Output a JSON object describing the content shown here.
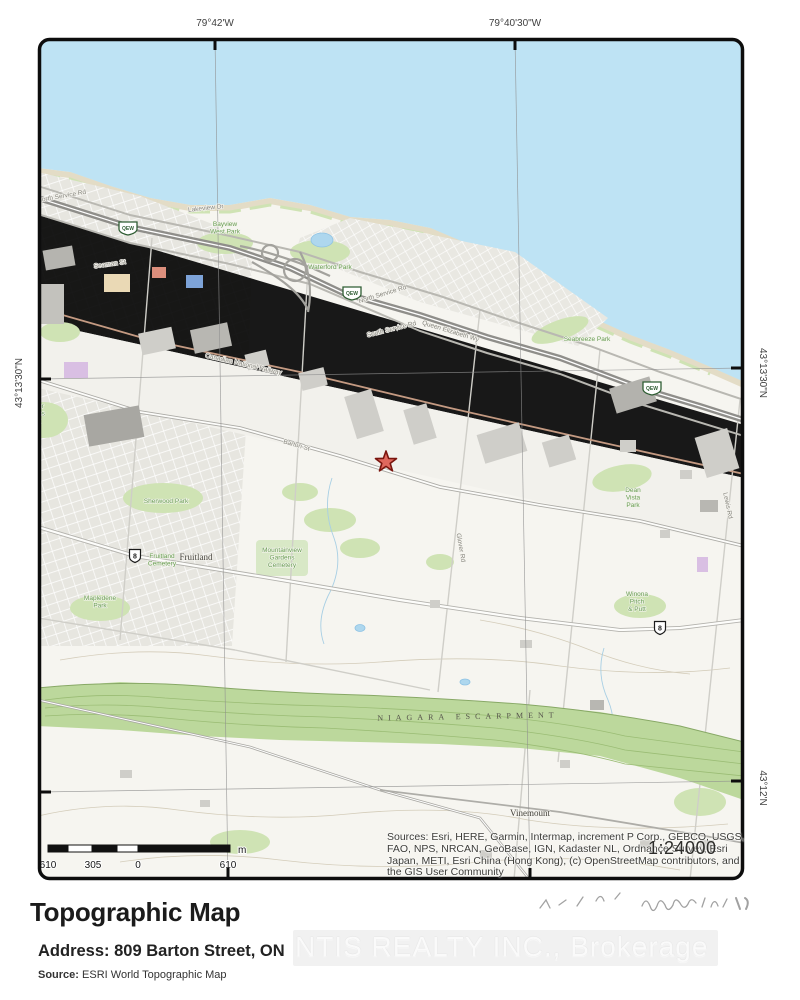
{
  "graticule": {
    "top": [
      {
        "label": "79°42'W"
      },
      {
        "label": "79°40'30\"W"
      }
    ],
    "left": [
      {
        "label": "43°13'30\"N"
      }
    ],
    "right": [
      {
        "label": "43°13'30\"N"
      },
      {
        "label": "43°12'N"
      }
    ]
  },
  "map": {
    "labels": [
      {
        "name": "road-label-north-service-rd-1",
        "t": "North Service Rd",
        "x": 62,
        "y": 198,
        "r": -10,
        "cls": "road"
      },
      {
        "name": "road-label-north-service-rd-2",
        "t": "North Service Rd",
        "x": 383,
        "y": 296,
        "r": -17,
        "cls": "road"
      },
      {
        "name": "road-label-south-service-rd",
        "t": "South Service Rd",
        "x": 392,
        "y": 331,
        "r": -14,
        "cls": "road"
      },
      {
        "name": "road-label-queen-elizabeth-wy",
        "t": "Queen Elizabeth Wy",
        "x": 450,
        "y": 333,
        "r": 17,
        "cls": "road",
        "size": 7
      },
      {
        "name": "rail-label-canadian-national-railway",
        "t": "Canadian National Railway",
        "x": 243,
        "y": 366,
        "r": 13,
        "cls": "road",
        "size": 6
      },
      {
        "name": "road-label-barton-st",
        "t": "Barton St",
        "x": 296,
        "y": 447,
        "r": 16,
        "cls": "road"
      },
      {
        "name": "road-label-seaman-st",
        "t": "Seaman St",
        "x": 110,
        "y": 266,
        "r": -8,
        "cls": "road",
        "size": 6
      },
      {
        "name": "road-label-lakeview-dr",
        "t": "Lakeview Dr",
        "x": 206,
        "y": 210,
        "r": -6,
        "cls": "road",
        "size": 6
      },
      {
        "name": "road-label-glover-rd",
        "t": "Glover Rd",
        "x": 459,
        "y": 548,
        "r": 80,
        "cls": "road"
      },
      {
        "name": "road-label-lewis-rd",
        "t": "Lewis Rd",
        "x": 726,
        "y": 506,
        "r": 78,
        "cls": "road"
      },
      {
        "name": "park-label-bayview-west",
        "t": "Bayview\nWest Park",
        "x": 225,
        "y": 226,
        "r": 0,
        "cls": "park"
      },
      {
        "name": "park-label-waterford",
        "t": "Waterford Park",
        "x": 330,
        "y": 269,
        "r": 0,
        "cls": "park"
      },
      {
        "name": "park-label-seabreeze",
        "t": "Seabreeze Park",
        "x": 587,
        "y": 341,
        "r": 0,
        "cls": "park"
      },
      {
        "name": "park-label-sherwood",
        "t": "Sherwood Park",
        "x": 166,
        "y": 503,
        "r": 0,
        "cls": "park"
      },
      {
        "name": "park-label-mapledene",
        "t": "Mapledene\nPark",
        "x": 100,
        "y": 600,
        "r": 0,
        "cls": "park"
      },
      {
        "name": "cemetery-label-fruitland",
        "t": "Fruitland\nCemetery",
        "x": 162,
        "y": 558,
        "r": 0,
        "cls": "park",
        "size": 6
      },
      {
        "name": "cemetery-label-mountainview",
        "t": "Mountainview\nGardens\nCemetery",
        "x": 282,
        "y": 552,
        "r": 0,
        "cls": "park",
        "size": 6
      },
      {
        "name": "park-label-dean-vista",
        "t": "Dean\nVista\nPark",
        "x": 633,
        "y": 492,
        "r": 0,
        "cls": "park"
      },
      {
        "name": "park-label-winona-pitch-putt",
        "t": "Winona\nPitch\n& Putt",
        "x": 637,
        "y": 596,
        "r": 0,
        "cls": "park"
      },
      {
        "name": "park-label-hunter-estates",
        "t": "Hunter\nEstates\nPark",
        "x": 34,
        "y": 408,
        "r": 0,
        "cls": "park",
        "anchor": "start"
      },
      {
        "name": "place-label-fruitland",
        "t": "Fruitland",
        "x": 196,
        "y": 560,
        "r": 0,
        "cls": "place"
      },
      {
        "name": "place-label-vinemount",
        "t": "Vinemount",
        "x": 530,
        "y": 816,
        "r": 0,
        "cls": "place"
      },
      {
        "name": "label-niagara-escarpment",
        "t": "NIAGARA ESCARPMENT",
        "x": 468,
        "y": 719,
        "r": -1,
        "cls": "escarpment",
        "ls": 5
      }
    ],
    "shields": [
      {
        "name": "qew-shield-1",
        "label": "QEW",
        "x": 128,
        "y": 228,
        "type": "qew"
      },
      {
        "name": "qew-shield-2",
        "label": "QEW",
        "x": 352,
        "y": 293,
        "type": "qew"
      },
      {
        "name": "qew-shield-3",
        "label": "QEW",
        "x": 652,
        "y": 388,
        "type": "qew"
      },
      {
        "name": "hwy8-shield-1",
        "label": "8",
        "x": 135,
        "y": 556,
        "type": "hwy"
      },
      {
        "name": "hwy8-shield-2",
        "label": "8",
        "x": 660,
        "y": 628,
        "type": "hwy"
      }
    ],
    "marker": {
      "shape": "star",
      "fill": "#df685d",
      "outline": "#7a150e"
    },
    "scale_bar": {
      "values": [
        "610",
        "305",
        "0",
        "610"
      ],
      "unit": "m"
    },
    "scale_ratio": "1:24000",
    "sources": "Sources: Esri, HERE, Garmin, Intermap, increment P Corp., GEBCO, USGS, FAO, NPS, NRCAN, GeoBase, IGN, Kadaster NL, Ordnance Survey, Esri Japan, METI, Esri China (Hong Kong), (c) OpenStreetMap contributors, and the GIS User Community"
  },
  "footer": {
    "title": "Topographic Map",
    "address_label": "Address:",
    "address_value": "809 Barton Street, ON",
    "source_label": "Source:",
    "source_value": "ESRI World Topographic Map",
    "watermark": "NTIS REALTY INC., Brokerage"
  },
  "colors": {
    "lake": "#bee3f4",
    "land": "#f6f5f0",
    "urban": "#e7e6e0",
    "escarpment": "#bcd89c",
    "marker": "#df685d",
    "border": "#0d0d0d"
  }
}
